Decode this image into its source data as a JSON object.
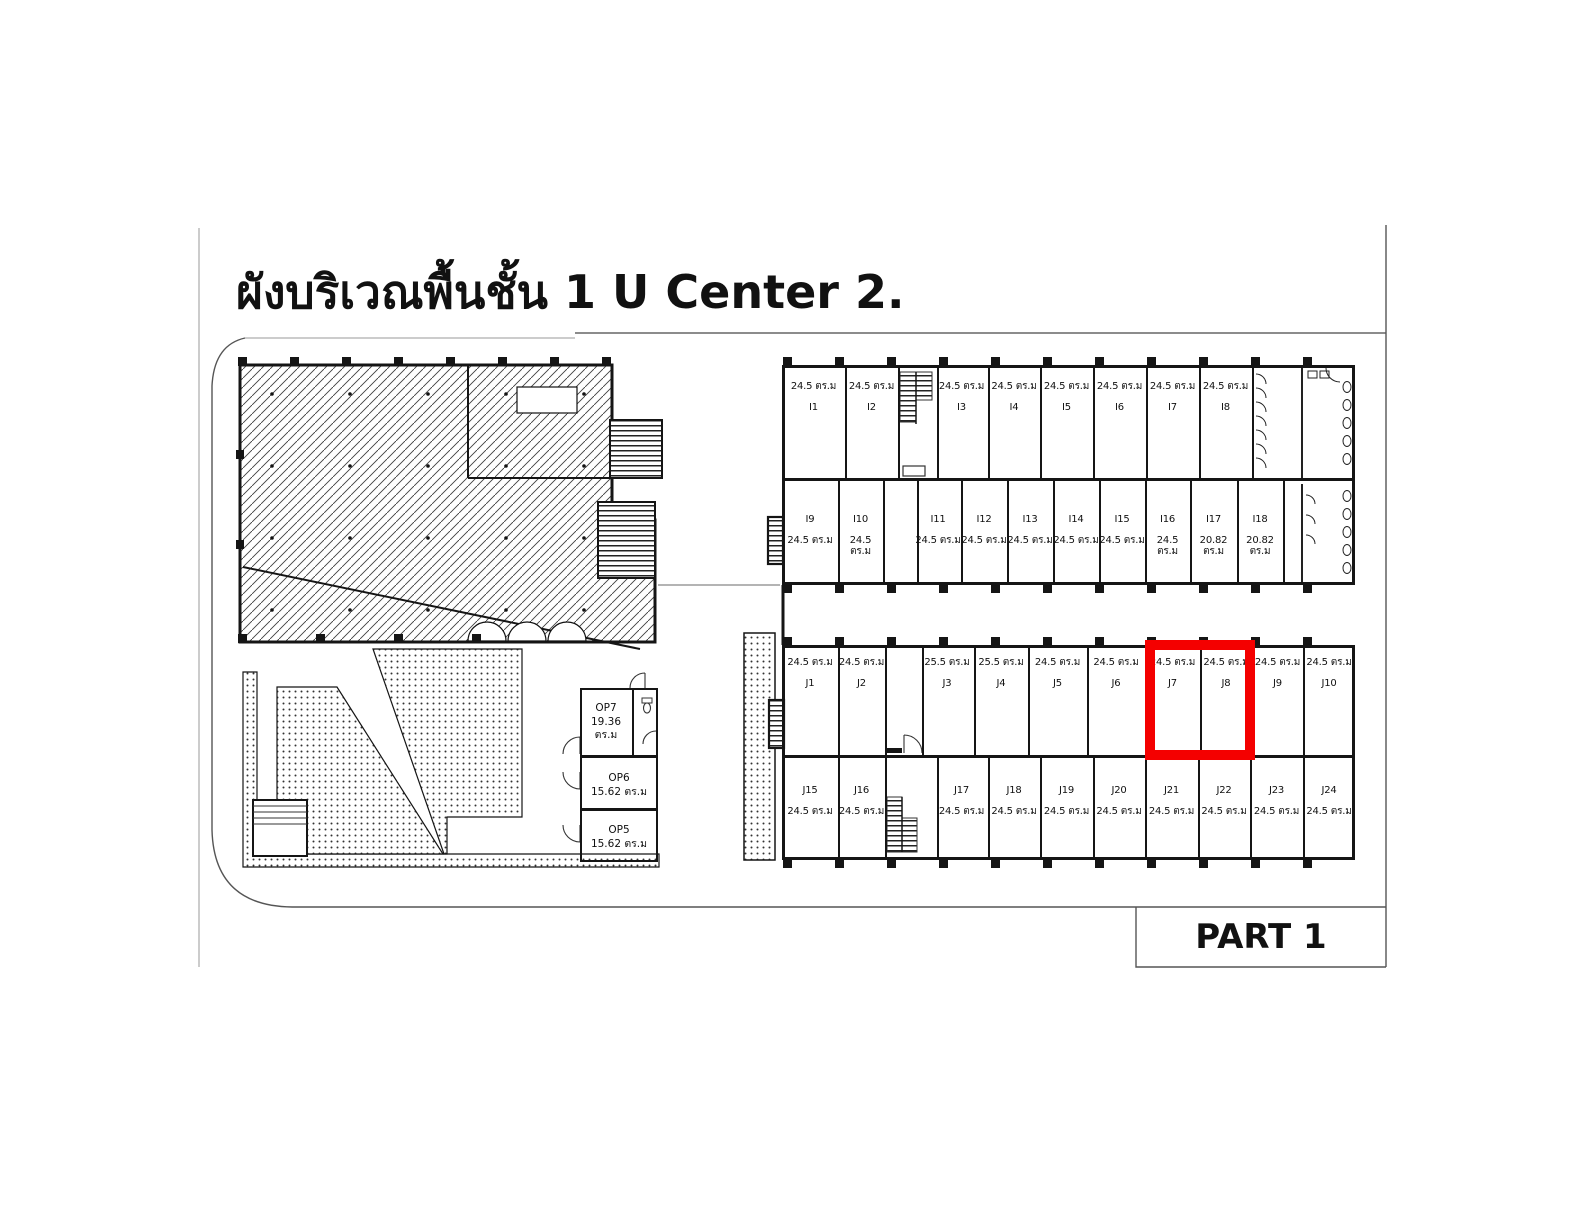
{
  "title": "ผังบริเวณพื้นชั้น 1 U Center 2.",
  "part_label": "PART 1",
  "highlight": {
    "color": "#F40000",
    "units": [
      "J7",
      "J8"
    ]
  },
  "b": {
    "i_top": [
      {
        "id": "I1",
        "area": "24.5 ตร.ม"
      },
      {
        "id": "I2",
        "area": "24.5 ตร.ม"
      },
      {
        "id": "I3",
        "area": "24.5 ตร.ม"
      },
      {
        "id": "I4",
        "area": "24.5 ตร.ม"
      },
      {
        "id": "I5",
        "area": "24.5 ตร.ม"
      },
      {
        "id": "I6",
        "area": "24.5 ตร.ม"
      },
      {
        "id": "I7",
        "area": "24.5 ตร.ม"
      },
      {
        "id": "I8",
        "area": "24.5 ตร.ม"
      }
    ],
    "i_bot": [
      {
        "id": "I9",
        "area": "24.5 ตร.ม"
      },
      {
        "id": "I10",
        "area": "24.5 ตร.ม"
      },
      {
        "id": "I11",
        "area": "24.5 ตร.ม"
      },
      {
        "id": "I12",
        "area": "24.5 ตร.ม"
      },
      {
        "id": "I13",
        "area": "24.5 ตร.ม"
      },
      {
        "id": "I14",
        "area": "24.5 ตร.ม"
      },
      {
        "id": "I15",
        "area": "24.5 ตร.ม"
      },
      {
        "id": "I16",
        "area": "24.5 ตร.ม"
      },
      {
        "id": "I17",
        "area": "20.82 ตร.ม"
      },
      {
        "id": "I18",
        "area": "20.82 ตร.ม"
      }
    ],
    "j_top": [
      {
        "id": "J1",
        "area": "24.5 ตร.ม"
      },
      {
        "id": "J2",
        "area": "24.5 ตร.ม"
      },
      {
        "id": "J3",
        "area": "25.5 ตร.ม"
      },
      {
        "id": "J4",
        "area": "25.5 ตร.ม"
      },
      {
        "id": "J5",
        "area": "24.5 ตร.ม"
      },
      {
        "id": "J6",
        "area": "24.5 ตร.ม"
      },
      {
        "id": "J7",
        "area": "24.5 ตร.ม"
      },
      {
        "id": "J8",
        "area": "24.5 ตร.ม"
      },
      {
        "id": "J9",
        "area": "24.5 ตร.ม"
      },
      {
        "id": "J10",
        "area": "24.5 ตร.ม"
      }
    ],
    "j_bot": [
      {
        "id": "J15",
        "area": "24.5 ตร.ม"
      },
      {
        "id": "J16",
        "area": "24.5 ตร.ม"
      },
      {
        "id": "J17",
        "area": "24.5 ตร.ม"
      },
      {
        "id": "J18",
        "area": "24.5 ตร.ม"
      },
      {
        "id": "J19",
        "area": "24.5 ตร.ม"
      },
      {
        "id": "J20",
        "area": "24.5 ตร.ม"
      },
      {
        "id": "J21",
        "area": "24.5 ตร.ม"
      },
      {
        "id": "J22",
        "area": "24.5 ตร.ม"
      },
      {
        "id": "J23",
        "area": "24.5 ตร.ม"
      },
      {
        "id": "J24",
        "area": "24.5 ตร.ม"
      }
    ],
    "op": [
      {
        "id": "OP7",
        "area": "19.36 ตร.ม"
      },
      {
        "id": "OP6",
        "area": "15.62 ตร.ม"
      },
      {
        "id": "OP5",
        "area": "15.62 ตร.ม"
      }
    ]
  }
}
